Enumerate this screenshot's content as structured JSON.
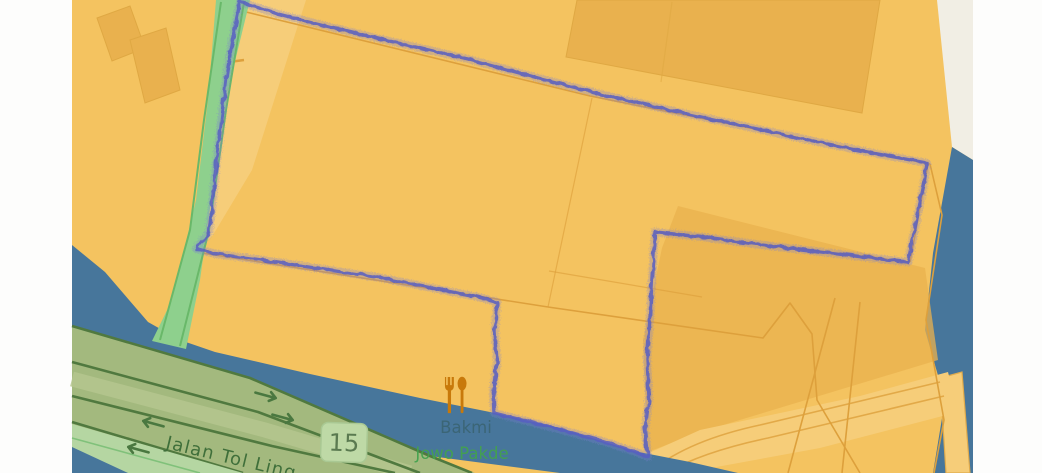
{
  "map": {
    "road": {
      "name": "Jalan Tol Ling",
      "ref": "15",
      "type": "toll-motorway"
    },
    "poi": {
      "type": "restaurant",
      "name_line1": "Bakmi",
      "name_line2": "Jowo Pakde"
    },
    "overlay": {
      "gps_trace": "closed jittery purple track around large parcel perimeter"
    }
  },
  "palette": {
    "background_white": "#fdfdfc",
    "cream": "#f1eee4",
    "land": "#f4c360",
    "land_light": "#f6cd79",
    "building": "#e9b14e",
    "building_edge": "#dfa843",
    "water": "#47769b",
    "parcel_line": "#dda03c",
    "road_green_fill": "#8ed08d",
    "road_green_edge": "#69b869",
    "toll_fill": "#a3b97e",
    "toll_casing": "#50793f",
    "toll_median": "#b5c68e",
    "verge": "#b5d6a2",
    "road_arrow": "#4a7840",
    "road_text": "#3f6f3a",
    "shield_bg": "#bed9a6",
    "shield_edge": "#a9c893",
    "shield_text": "#5a7a50",
    "poi_icon": "#c8790a",
    "poi_label_water": "#3a6472",
    "poi_label_green": "#43a24e",
    "trace": "#585fc2",
    "trace_halo": "#7b7fd4"
  }
}
